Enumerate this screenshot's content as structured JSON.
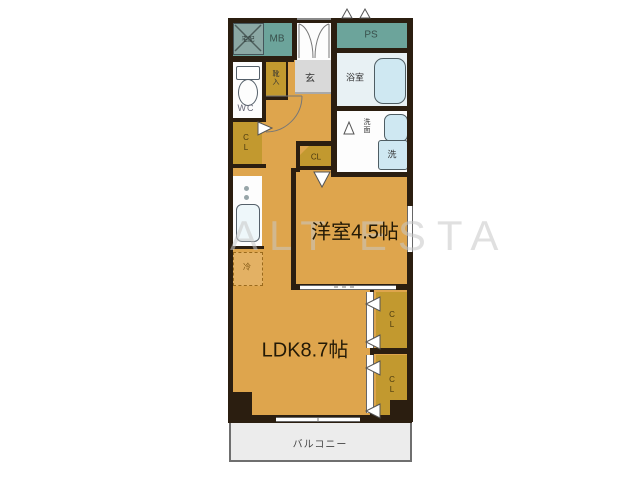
{
  "watermark": "ALT ESTA",
  "rooms": {
    "western": {
      "label": "洋室4.5帖"
    },
    "ldk": {
      "label": "LDK8.7帖"
    },
    "balcony": {
      "label": "バルコニー"
    },
    "bath": {
      "label": "浴室"
    },
    "washroom": {
      "label": "洗面"
    },
    "toilet": {
      "label": "WC"
    },
    "entrance": {
      "label": "玄"
    },
    "shoe_box": {
      "label": "靴入"
    },
    "meter_box": {
      "label": "MB"
    },
    "pipe_space": {
      "label": "PS"
    }
  },
  "closets": {
    "hall": {
      "label": "CL"
    },
    "bedroom": {
      "label": "CL"
    },
    "ldk_upper": {
      "label": "CL"
    },
    "ldk_lower": {
      "label": "CL"
    }
  },
  "fixtures": {
    "delivery_box": {
      "label": "宅配"
    },
    "washer": {
      "label": "洗"
    },
    "refrigerator": {
      "label": "冷"
    }
  },
  "colors": {
    "wall": "#2b1e10",
    "floor": "#dea54d",
    "closet": "#c2992f",
    "service": "#6ca49b",
    "wet_room": "#e8f1f4",
    "fixture_fill": "#cfe8f2",
    "entrance_floor": "#d9d9d9",
    "balcony": "#ececec",
    "watermark": "#cccccc"
  }
}
